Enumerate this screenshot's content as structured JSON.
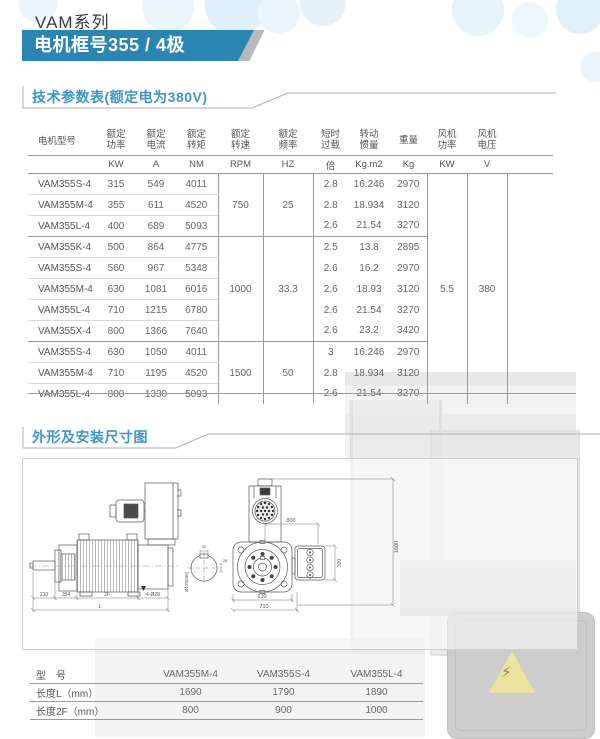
{
  "header": {
    "series": "VAM系列",
    "banner": "电机框号355 / 4极"
  },
  "sections": {
    "specs": "技术参数表(额定电为380V)",
    "dimensions": "外形及安装尺寸图"
  },
  "spec_table": {
    "columns": {
      "model": "电机型号",
      "power": [
        "额定",
        "功率"
      ],
      "current": [
        "额定",
        "电流"
      ],
      "torque": [
        "额定",
        "转矩"
      ],
      "speed": [
        "额定",
        "转速"
      ],
      "freq": [
        "额定",
        "频率"
      ],
      "overload": [
        "短时",
        "过载"
      ],
      "inertia": [
        "转动",
        "惯量"
      ],
      "weight": [
        "重量"
      ],
      "fan_power": [
        "风机",
        "功率"
      ],
      "fan_voltage": [
        "风机",
        "电压"
      ]
    },
    "units": {
      "power": "KW",
      "current": "A",
      "torque": "NM",
      "speed": "RPM",
      "freq": "HZ",
      "overload": "倍",
      "inertia": "Kg.m2",
      "weight": "Kg",
      "fan_power": "KW",
      "fan_voltage": "V"
    },
    "speed_groups": [
      "750",
      "1000",
      "1500"
    ],
    "freq_groups": [
      "25",
      "33.3",
      "50"
    ],
    "fan_power_value": "5.5",
    "fan_voltage_value": "380",
    "rows": [
      {
        "model": "VAM355S-4",
        "power": "315",
        "current": "549",
        "torque": "4011",
        "overload": "2.8",
        "inertia": "16.246",
        "weight": "2970"
      },
      {
        "model": "VAM355M-4",
        "power": "355",
        "current": "611",
        "torque": "4520",
        "overload": "2.8",
        "inertia": "18.934",
        "weight": "3120"
      },
      {
        "model": "VAM355L-4",
        "power": "400",
        "current": "689",
        "torque": "5093",
        "overload": "2.6",
        "inertia": "21.54",
        "weight": "3270"
      },
      {
        "model": "VAM355K-4",
        "power": "500",
        "current": "864",
        "torque": "4775",
        "overload": "2.5",
        "inertia": "13.8",
        "weight": "2895"
      },
      {
        "model": "VAM355S-4",
        "power": "560",
        "current": "967",
        "torque": "5348",
        "overload": "2.6",
        "inertia": "16.2",
        "weight": "2970"
      },
      {
        "model": "VAM355M-4",
        "power": "630",
        "current": "1081",
        "torque": "6016",
        "overload": "2.6",
        "inertia": "18.93",
        "weight": "3120"
      },
      {
        "model": "VAM355L-4",
        "power": "710",
        "current": "1215",
        "torque": "6780",
        "overload": "2.6",
        "inertia": "21.54",
        "weight": "3270"
      },
      {
        "model": "VAM355X-4",
        "power": "800",
        "current": "1366",
        "torque": "7640",
        "overload": "2.6",
        "inertia": "23.2",
        "weight": "3420"
      },
      {
        "model": "VAM355S-4",
        "power": "630",
        "current": "1050",
        "torque": "4011",
        "overload": "3",
        "inertia": "16.246",
        "weight": "2970"
      },
      {
        "model": "VAM355M-4",
        "power": "710",
        "current": "1195",
        "torque": "4520",
        "overload": "2.8",
        "inertia": "18.934",
        "weight": "3120"
      },
      {
        "model": "VAM355L-4",
        "power": "800",
        "current": "1330",
        "torque": "5093",
        "overload": "2.6",
        "inertia": "21.54",
        "weight": "3270"
      }
    ]
  },
  "drawings": {
    "side": {
      "dim_210": "210",
      "dim_254": "254",
      "dim_2f": "2F",
      "dim_holes": "4-Ø28",
      "dim_l": "L",
      "shaft": "Ø120(m6)",
      "detail_top": "32",
      "detail_side": "28"
    },
    "front": {
      "dim_800": "800",
      "dim_1600": "1600",
      "dim_320": "320",
      "dim_610": "610",
      "dim_710": "710"
    }
  },
  "dim_table": {
    "header": {
      "label": "型　号",
      "models": [
        "VAM355M-4",
        "VAM355S-4",
        "VAM355L-4"
      ]
    },
    "rows": [
      {
        "label": "长度L（mm）",
        "values": [
          "1690",
          "1790",
          "1890"
        ]
      },
      {
        "label": "长度2F（mm）",
        "values": [
          "800",
          "900",
          "1000"
        ]
      }
    ]
  }
}
